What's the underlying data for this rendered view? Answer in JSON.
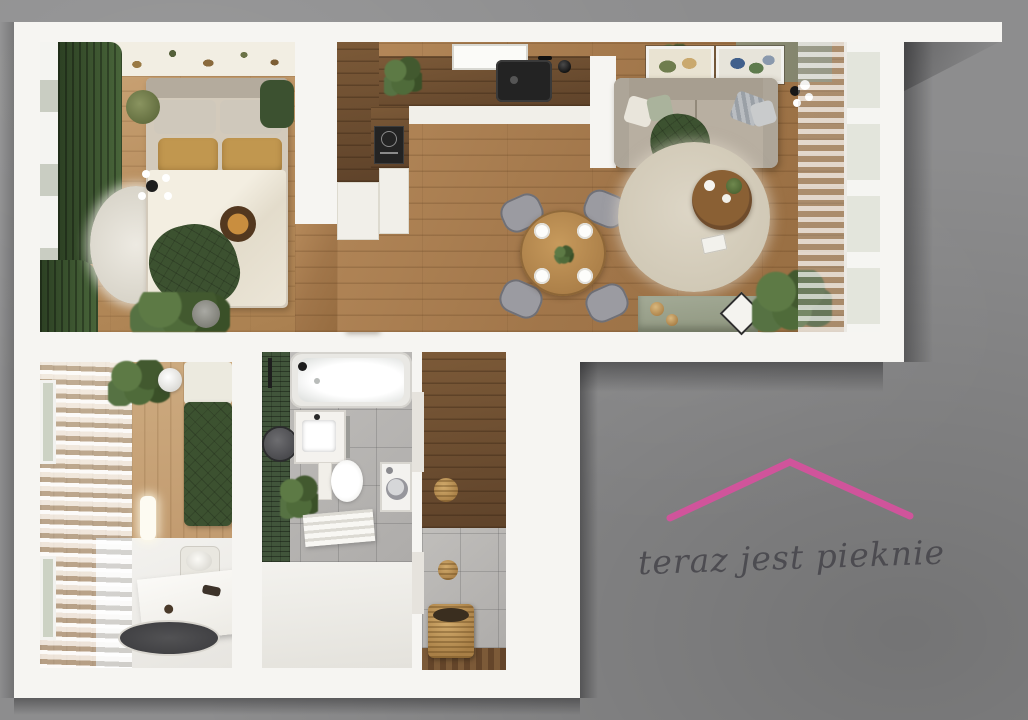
{
  "scene": {
    "title": "apartment-floor-plan-3d-render",
    "description": "Top-down 3D architectural render of an apartment (bedroom, kitchen with dining area, living room, second room, bathroom, hallway) cut out on a gray concrete background with a pink-roof logo watermark"
  },
  "watermark": {
    "text": "teraz jest pieknie",
    "roof_color": "#d0549b",
    "text_color": "#45444a"
  },
  "palette": {
    "bg": "#8d8d8e",
    "wall": "#f6f5f2",
    "wall_shade": "#e6e3dd",
    "wood_light": "#c3a076",
    "wood_mid": "#a87c4e",
    "wood_dark": "#6e4e30",
    "green_dark": "#3c5130",
    "leaf": "#4f6b3c",
    "sage": "#99a08c",
    "beige_rug": "#d8d1c0",
    "taupe_sofa": "#b8afa1",
    "bed_white": "#ece6d8",
    "tan_pillow": "#c1974f",
    "tile_gray": "#b7b5b2",
    "tile_green": "#41553b",
    "ink": "#232323",
    "chair_gray": "#9b9ba1",
    "script_ink": "#45444a"
  },
  "rooms": [
    {
      "name": "bedroom"
    },
    {
      "name": "kitchen-dining"
    },
    {
      "name": "living-room"
    },
    {
      "name": "second-room"
    },
    {
      "name": "bathroom"
    },
    {
      "name": "hallway"
    }
  ]
}
